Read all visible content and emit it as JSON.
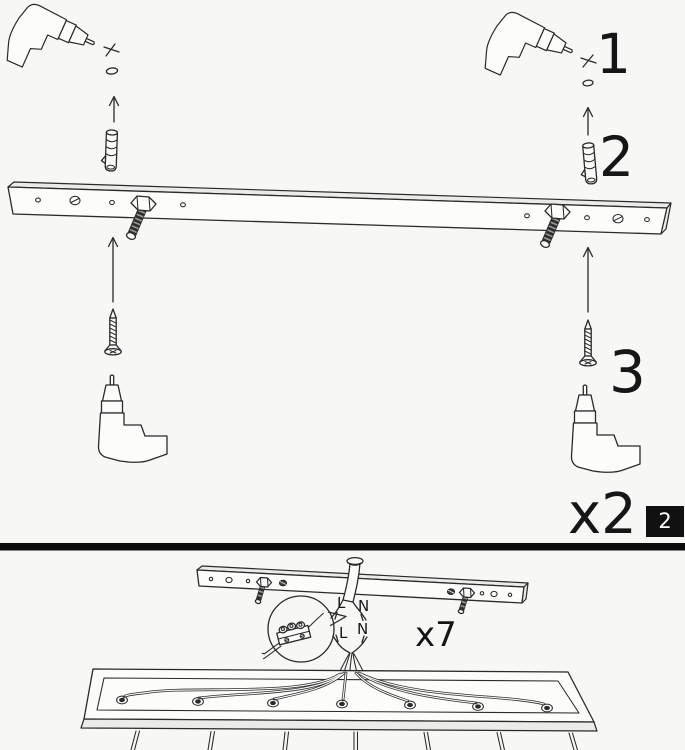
{
  "page": {
    "background_color": "#f7f7f5",
    "line_color": "#2a2a2a",
    "divider_color": "#0d0d0d"
  },
  "page_badge": {
    "number": "2",
    "background_color": "#111111",
    "text_color": "#ffffff"
  },
  "panel_step2": {
    "step_labels": [
      {
        "id": "drill-pilot-hole",
        "number": "1"
      },
      {
        "id": "insert-wall-plug",
        "number": "2"
      },
      {
        "id": "screw-rail",
        "number": "3"
      }
    ],
    "repeat_label": "x2",
    "icons": [
      "drill-icon",
      "drill-mark-x-icon",
      "pilot-hole-icon",
      "arrow-up-icon",
      "wall-plug-icon",
      "mounting-rail",
      "stud-bolt-icon",
      "wood-screw-icon"
    ]
  },
  "panel_step3": {
    "repeat_label": "x7",
    "supply_wire_labels": {
      "live": "L",
      "neutral": "N"
    },
    "fixture_wire_labels": {
      "live": "L",
      "neutral": "N"
    },
    "icons": [
      "ceiling-bracket",
      "supply-cable",
      "magnifier-balloon-icon",
      "terminal-block-icon",
      "canopy-pan",
      "cable-gland-icon",
      "pendant-cord"
    ]
  }
}
